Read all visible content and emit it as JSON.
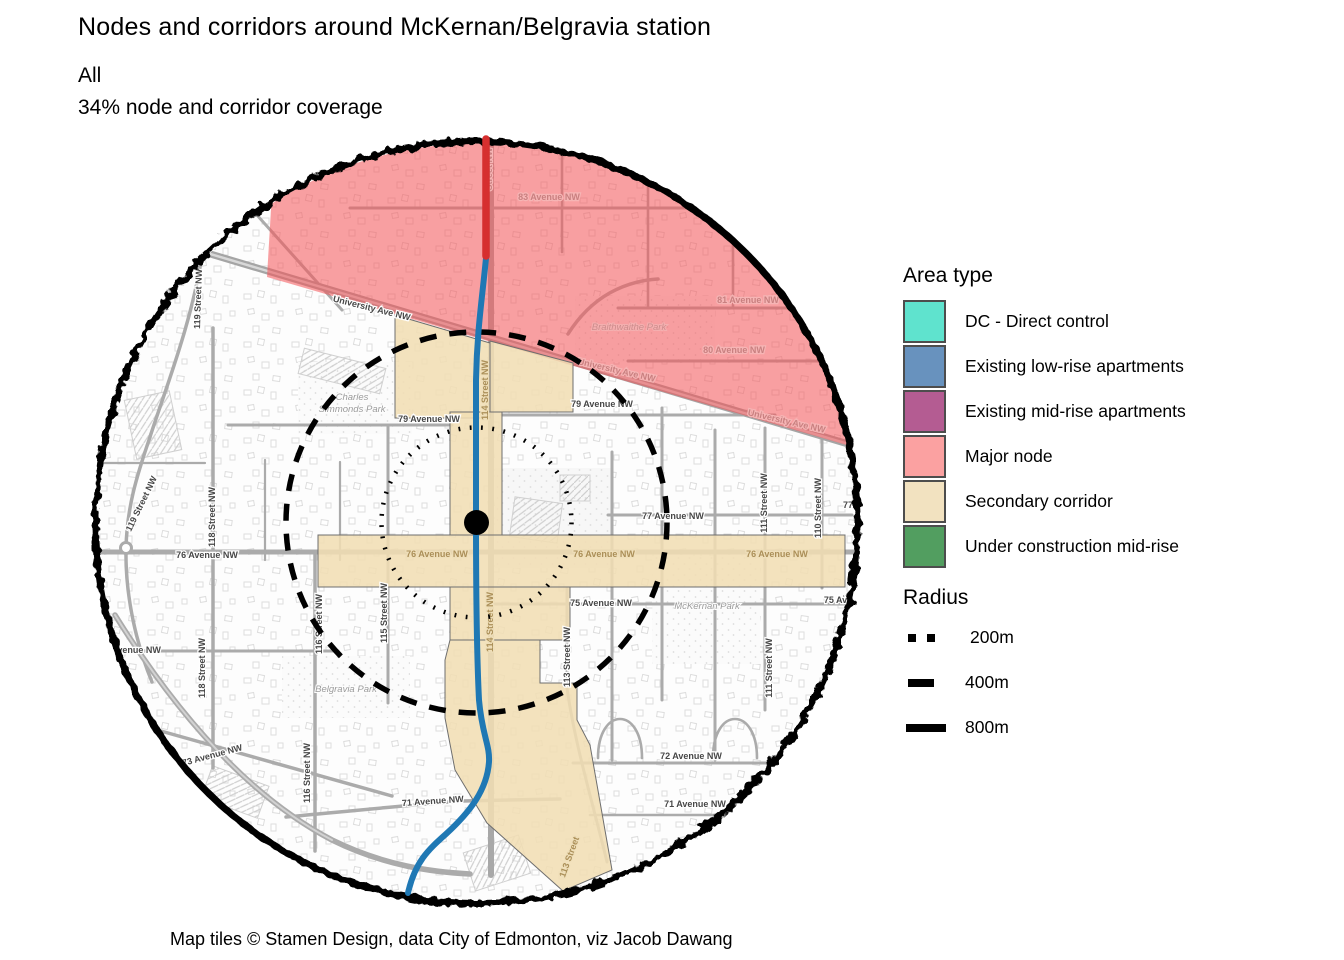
{
  "header": {
    "title": "Nodes and corridors around McKernan/Belgravia station",
    "subtitle_line1": "All",
    "subtitle_line2": "34% node and corridor coverage"
  },
  "caption": "Map tiles © Stamen Design, data City of Edmonton, viz Jacob Dawang",
  "colors": {
    "major_node_fill": "#F4565A",
    "secondary_corridor_fill": "#F1DEB3",
    "corridor_border": "#6e6e6e",
    "lrt_blue": "#1F78B4",
    "lrt_red": "#D62F2F",
    "station_dot": "#000000",
    "radius_ring": "#000000",
    "road_gray": "#ABABAB"
  },
  "legend": {
    "area_type": {
      "title": "Area type",
      "items": [
        {
          "label": "DC - Direct control",
          "color": "#5FE3CE"
        },
        {
          "label": "Existing low-rise apartments",
          "color": "#6892BE"
        },
        {
          "label": "Existing mid-rise apartments",
          "color": "#B45C92"
        },
        {
          "label": "Major node",
          "color": "#FBA1A1"
        },
        {
          "label": "Secondary corridor",
          "color": "#F2E2C0"
        },
        {
          "label": "Under construction mid-rise",
          "color": "#529E60"
        }
      ]
    },
    "radius": {
      "title": "Radius",
      "items": [
        {
          "label": "200m",
          "style": "dotted"
        },
        {
          "label": "400m",
          "style": "dashed"
        },
        {
          "label": "800m",
          "style": "solid"
        }
      ]
    }
  },
  "map": {
    "street_labels": [
      "83 Avenue NW",
      "81 Avenue NW",
      "80 Avenue NW",
      "University Ave NW",
      "University Ave NW",
      "University Ave NW",
      "79 Avenue NW",
      "79 Avenue NW",
      "77 Avenue NW",
      "77",
      "76 Avenue NW",
      "76 Avenue NW",
      "76 Avenue NW",
      "76 Avenue NW",
      "75 Avenue NW",
      "75 Ave",
      "74 Avenue NW",
      "73 Avenue NW",
      "72 Avenue NW",
      "71 Avenue NW",
      "71 Avenue NW",
      "119 Street NW",
      "119 Street NW",
      "118 Street NW",
      "118 Street NW",
      "116 Street NW",
      "116 Street NW",
      "115 Street NW",
      "Street NW",
      "114 Street NW",
      "114 Street NW",
      "113 Street NW",
      "113 Street",
      "111 Street NW",
      "111 Street NW",
      "110 Street NW"
    ],
    "park_labels": [
      "Charles",
      "Simmonds Park",
      "Braithwaithe Park",
      "McKernan Park",
      "Belgravia Park"
    ]
  }
}
